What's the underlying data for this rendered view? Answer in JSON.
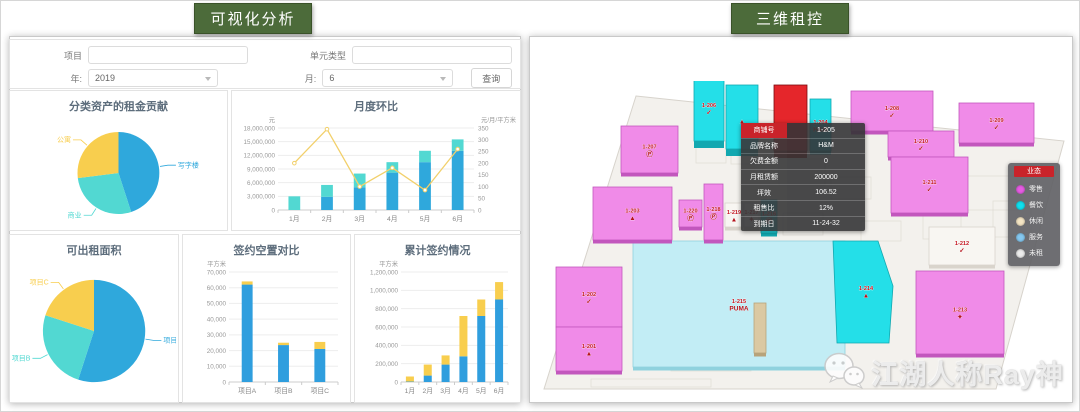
{
  "left_panel": {
    "badge": "可视化分析",
    "filter": {
      "project_label": "项目",
      "project_value": "",
      "unit_type_label": "单元类型",
      "unit_type_value": "",
      "year_label": "年:",
      "year_value": "2019",
      "month_label": "月:",
      "month_value": "6",
      "search_button": "查询"
    }
  },
  "right_panel": {
    "badge": "三维租控",
    "tooltip": {
      "rows": [
        {
          "label": "商铺号",
          "value": "1-205"
        },
        {
          "label": "品牌名称",
          "value": "H&M"
        },
        {
          "label": "欠费金额",
          "value": "0"
        },
        {
          "label": "月租赁额",
          "value": "200000"
        },
        {
          "label": "坪效",
          "value": "106.52"
        },
        {
          "label": "租售比",
          "value": "12%"
        },
        {
          "label": "到期日",
          "value": "11-24-32"
        }
      ]
    },
    "legend": {
      "title": "业态",
      "items": [
        {
          "label": "零售",
          "color": "#e55ce2"
        },
        {
          "label": "餐饮",
          "color": "#10dfee"
        },
        {
          "label": "休闲",
          "color": "#f4e5c4"
        },
        {
          "label": "服务",
          "color": "#85c8f0"
        },
        {
          "label": "未租",
          "color": "#ececec"
        }
      ]
    },
    "watermark": "江湖人称Ray神",
    "map": {
      "category_colors": {
        "pink": {
          "fill": "#f08be8",
          "shade": "#c257bd"
        },
        "cyan": {
          "fill": "#24dfe8",
          "shade": "#12a8b0"
        },
        "lightcyan": {
          "fill": "#c2edf5",
          "shade": "#8fd2de"
        },
        "red": {
          "fill": "#e5262b",
          "shade": "#9c1216"
        },
        "white": {
          "fill": "#f8f6f2",
          "shade": "#d9d4cc"
        },
        "tan": {
          "fill": "#dbc9a2",
          "shade": "#b7a37a"
        }
      },
      "floor_points": [
        [
          105,
          15
        ],
        [
          533,
          60
        ],
        [
          465,
          308
        ],
        [
          13,
          308
        ]
      ],
      "detail_rects": [
        [
          200,
          58,
          40,
          25
        ],
        [
          248,
          78,
          46,
          26
        ],
        [
          300,
          96,
          40,
          22
        ],
        [
          165,
          60,
          30,
          22
        ],
        [
          392,
          128,
          38,
          30
        ],
        [
          252,
          132,
          40,
          22
        ],
        [
          432,
          95,
          58,
          34
        ],
        [
          140,
          252,
          80,
          38
        ],
        [
          242,
          200,
          68,
          28
        ],
        [
          462,
          120,
          38,
          36
        ],
        [
          60,
          298,
          120,
          8
        ],
        [
          330,
          140,
          40,
          20
        ]
      ],
      "blocks": [
        {
          "id": "1-206",
          "x": 163,
          "y": -6,
          "w": 30,
          "h": 66,
          "cat": "cyan",
          "label": "1-206",
          "brand": "NIKE",
          "glyph": "✓",
          "tall": true
        },
        {
          "id": "tower-b",
          "x": 195,
          "y": 4,
          "w": 32,
          "h": 64,
          "cat": "cyan",
          "label": "",
          "brand": "adidas",
          "glyph": "▲",
          "tall": true
        },
        {
          "id": "1-205",
          "x": 243,
          "y": 4,
          "w": 33,
          "h": 66,
          "cat": "red",
          "label": "",
          "brand": "H&M",
          "glyph": "",
          "tall": true,
          "selected": true
        },
        {
          "id": "1-204",
          "x": 279,
          "y": 18,
          "w": 21,
          "h": 52,
          "cat": "cyan",
          "label": "1-204",
          "brand": "H&M",
          "glyph": "H&M"
        },
        {
          "id": "1-208",
          "x": 320,
          "y": 10,
          "w": 82,
          "h": 40,
          "cat": "pink",
          "label": "1-208",
          "brand": "NIKE",
          "glyph": "✓"
        },
        {
          "id": "1-209",
          "x": 428,
          "y": 22,
          "w": 75,
          "h": 40,
          "cat": "pink",
          "label": "1-209",
          "brand": "NIKE",
          "glyph": "✓"
        },
        {
          "id": "1-210",
          "x": 357,
          "y": 50,
          "w": 66,
          "h": 26,
          "cat": "pink",
          "label": "1-210",
          "brand": "NIKE",
          "glyph": "✓"
        },
        {
          "id": "1-211",
          "x": 360,
          "y": 76,
          "w": 77,
          "h": 56,
          "cat": "pink",
          "label": "1-211",
          "brand": "NIKE",
          "glyph": "✓"
        },
        {
          "id": "1-212",
          "x": 398,
          "y": 146,
          "w": 66,
          "h": 38,
          "cat": "white",
          "label": "1-212",
          "brand": "NIKE",
          "glyph": "✓"
        },
        {
          "id": "1-213",
          "x": 385,
          "y": 190,
          "w": 88,
          "h": 83,
          "cat": "pink",
          "label": "1-213",
          "brand": "apple",
          "glyph": "✦"
        },
        {
          "id": "1-215",
          "x": 102,
          "y": 160,
          "w": 212,
          "h": 126,
          "cat": "lightcyan",
          "label": "1-215",
          "brand": "PUMA",
          "glyph": "PUMA"
        },
        {
          "id": "1-214",
          "points": [
            [
              302,
              160
            ],
            [
              347,
              160
            ],
            [
              362,
              205
            ],
            [
              358,
              262
            ],
            [
              306,
              262
            ]
          ],
          "cat": "cyan",
          "label": "1-214",
          "brand": "adidas",
          "glyph": "▲"
        },
        {
          "id": "1-207",
          "x": 90,
          "y": 45,
          "w": 57,
          "h": 47,
          "cat": "pink",
          "label": "1-207",
          "brand": "PUMA",
          "glyph": "Ⓟ"
        },
        {
          "id": "1-203",
          "x": 62,
          "y": 106,
          "w": 79,
          "h": 53,
          "cat": "pink",
          "label": "1-203",
          "brand": "adidas",
          "glyph": "▲"
        },
        {
          "id": "1-220",
          "x": 148,
          "y": 119,
          "w": 23,
          "h": 27,
          "cat": "pink",
          "label": "1-220",
          "brand": "PUMA",
          "glyph": "Ⓟ"
        },
        {
          "id": "1-218",
          "x": 173,
          "y": 103,
          "w": 19,
          "h": 56,
          "cat": "pink",
          "label": "1-218",
          "brand": "PUMA",
          "glyph": "Ⓟ"
        },
        {
          "id": "1-219",
          "x": 194,
          "y": 122,
          "w": 18,
          "h": 24,
          "cat": "white",
          "label": "1-219",
          "brand": "adidas",
          "glyph": "▲"
        },
        {
          "id": "1-217",
          "x": 213,
          "y": 122,
          "w": 15,
          "h": 24,
          "cat": "white",
          "label": "1-217",
          "brand": "apple",
          "glyph": "✦"
        },
        {
          "id": "1-216",
          "x": 230,
          "y": 119,
          "w": 16,
          "h": 33,
          "cat": "cyan",
          "label": "1-216",
          "brand": "PUMA",
          "glyph": "Ⓟ"
        },
        {
          "id": "1-202",
          "x": 25,
          "y": 186,
          "w": 66,
          "h": 60,
          "cat": "pink",
          "label": "1-202",
          "brand": "NIKE",
          "glyph": "✓"
        },
        {
          "id": "1-201",
          "x": 25,
          "y": 246,
          "w": 66,
          "h": 44,
          "cat": "pink",
          "label": "1-201",
          "brand": "adidas",
          "glyph": "▲"
        },
        {
          "id": "pillar",
          "x": 223,
          "y": 222,
          "w": 12,
          "h": 50,
          "cat": "tan",
          "label": "",
          "brand": "",
          "glyph": ""
        }
      ]
    }
  },
  "chart_data": [
    {
      "type": "pie",
      "key": "rent_contribution",
      "title": "分类资产的租金贡献",
      "slices": [
        {
          "label": "写字楼",
          "value": 45,
          "color": "#2fa8dc"
        },
        {
          "label": "商业",
          "value": 28,
          "color": "#52d8d2"
        },
        {
          "label": "公寓",
          "value": 27,
          "color": "#f8ce4e"
        }
      ]
    },
    {
      "type": "bar",
      "key": "monthly",
      "title": "月度环比",
      "categories": [
        "1月",
        "2月",
        "3月",
        "4月",
        "5月",
        "6月"
      ],
      "left_axis": {
        "unit": "元",
        "max": 18000000,
        "step": 3000000
      },
      "right_axis": {
        "unit": "元/月/平方米",
        "max": 350,
        "step": 50
      },
      "bar_width_ratio": 0.36,
      "series": [
        {
          "name": "已签约",
          "type": "bar",
          "color": "#2fa8dc",
          "values": [
            0,
            2900000,
            5000000,
            8200000,
            10500000,
            13000000
          ]
        },
        {
          "name": "新增",
          "type": "bar",
          "color": "#52d8d2",
          "values": [
            3000000,
            2600000,
            3000000,
            2300000,
            2500000,
            2500000
          ]
        },
        {
          "name": "单价",
          "type": "line",
          "color": "#f2d06b",
          "axis": "right",
          "values": [
            200,
            345,
            100,
            180,
            85,
            260
          ]
        }
      ]
    },
    {
      "type": "pie",
      "key": "rentable_area",
      "title": "可出租面积",
      "slices": [
        {
          "label": "项目A",
          "value": 55,
          "color": "#2fa8dc"
        },
        {
          "label": "项目B",
          "value": 25,
          "color": "#52d8d2"
        },
        {
          "label": "项目C",
          "value": 20,
          "color": "#f8ce4e"
        }
      ]
    },
    {
      "type": "bar",
      "key": "vacancy",
      "title": "签约空置对比",
      "categories": [
        "项目A",
        "项目B",
        "项目C"
      ],
      "left_axis": {
        "unit": "平方米",
        "max": 70000,
        "step": 10000
      },
      "bar_width_ratio": 0.3,
      "series": [
        {
          "name": "签约",
          "type": "bar",
          "color": "#2f9ede",
          "values": [
            62000,
            23500,
            21000
          ]
        },
        {
          "name": "空置",
          "type": "bar",
          "color": "#f8ce4e",
          "values": [
            2000,
            1500,
            4500
          ]
        }
      ]
    },
    {
      "type": "bar",
      "key": "cumulative",
      "title": "累计签约情况",
      "categories": [
        "1月",
        "2月",
        "3月",
        "4月",
        "5月",
        "6月"
      ],
      "left_axis": {
        "unit": "平方米",
        "max": 1200000,
        "step": 200000
      },
      "bar_width_ratio": 0.45,
      "series": [
        {
          "name": "已签约",
          "type": "bar",
          "color": "#2f9ede",
          "values": [
            5000,
            70000,
            190000,
            280000,
            720000,
            900000
          ]
        },
        {
          "name": "新签约",
          "type": "bar",
          "color": "#f8ce4e",
          "values": [
            55000,
            120000,
            100000,
            440000,
            180000,
            190000
          ]
        }
      ]
    }
  ]
}
